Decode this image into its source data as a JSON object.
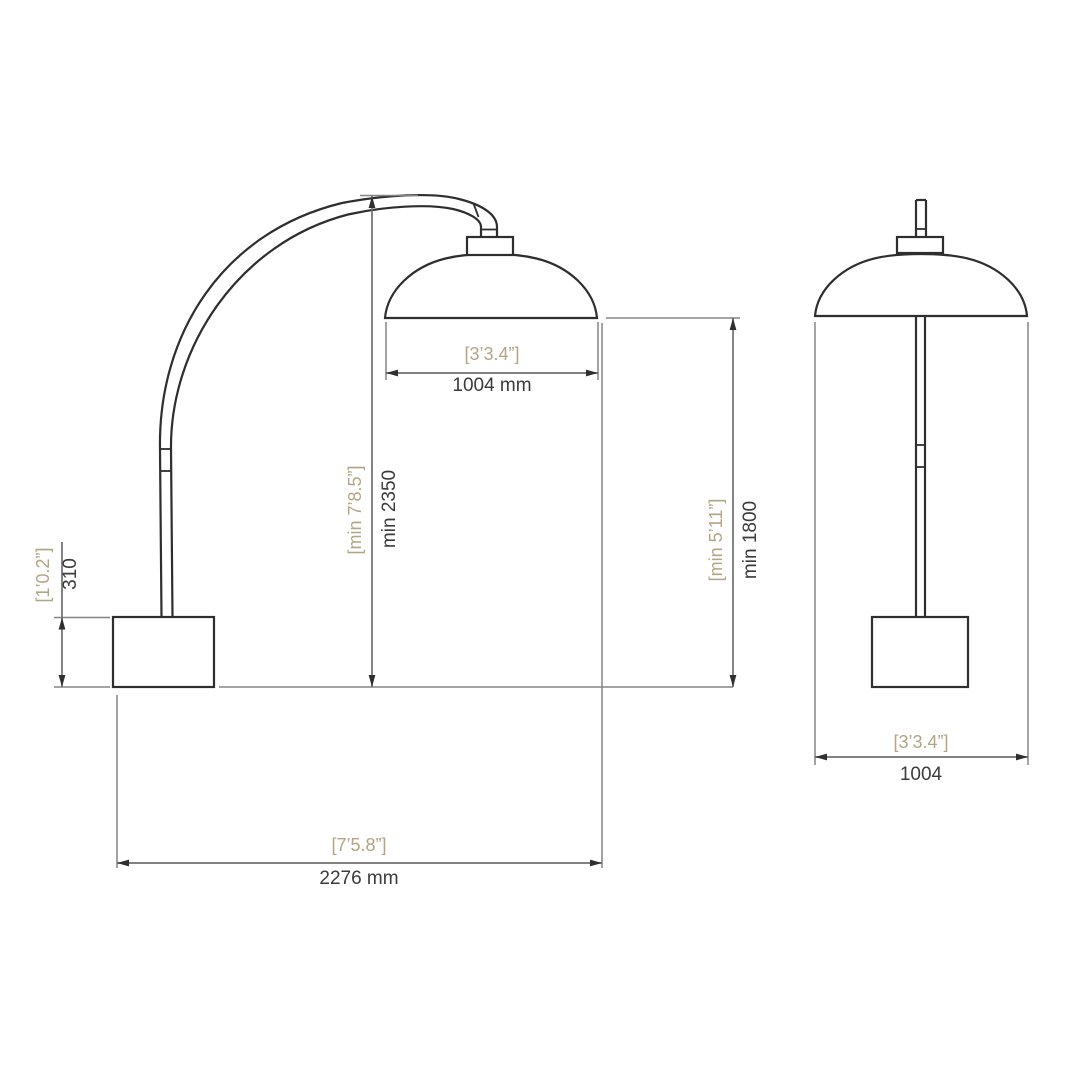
{
  "drawing": {
    "type": "technical-dimension-drawing",
    "subject": "arc floor lamp, side view and front view",
    "colors": {
      "background": "#ffffff",
      "outline": "#2e2e2e",
      "dimension_line": "#6f6f6f",
      "extension_line": "#858585",
      "arrowhead": "#2f2f2f",
      "metric_text": "#3b3b3b",
      "imperial_text": "#b3a584"
    }
  },
  "dimensions": {
    "side_shade_width": {
      "imperial": "[3’3.4”]",
      "metric": "1004 mm"
    },
    "side_overall_height": {
      "imperial": "[min 7’8.5”]",
      "metric": "min 2350"
    },
    "side_shade_height": {
      "imperial": "[min 5’11”]",
      "metric": "min 1800"
    },
    "side_base_height": {
      "imperial": "[1’0.2”]",
      "metric": "310"
    },
    "side_reach": {
      "imperial": "[7’5.8”]",
      "metric": "2276 mm"
    },
    "front_shade_width": {
      "imperial": "[3’3.4”]",
      "metric": "1004"
    }
  }
}
